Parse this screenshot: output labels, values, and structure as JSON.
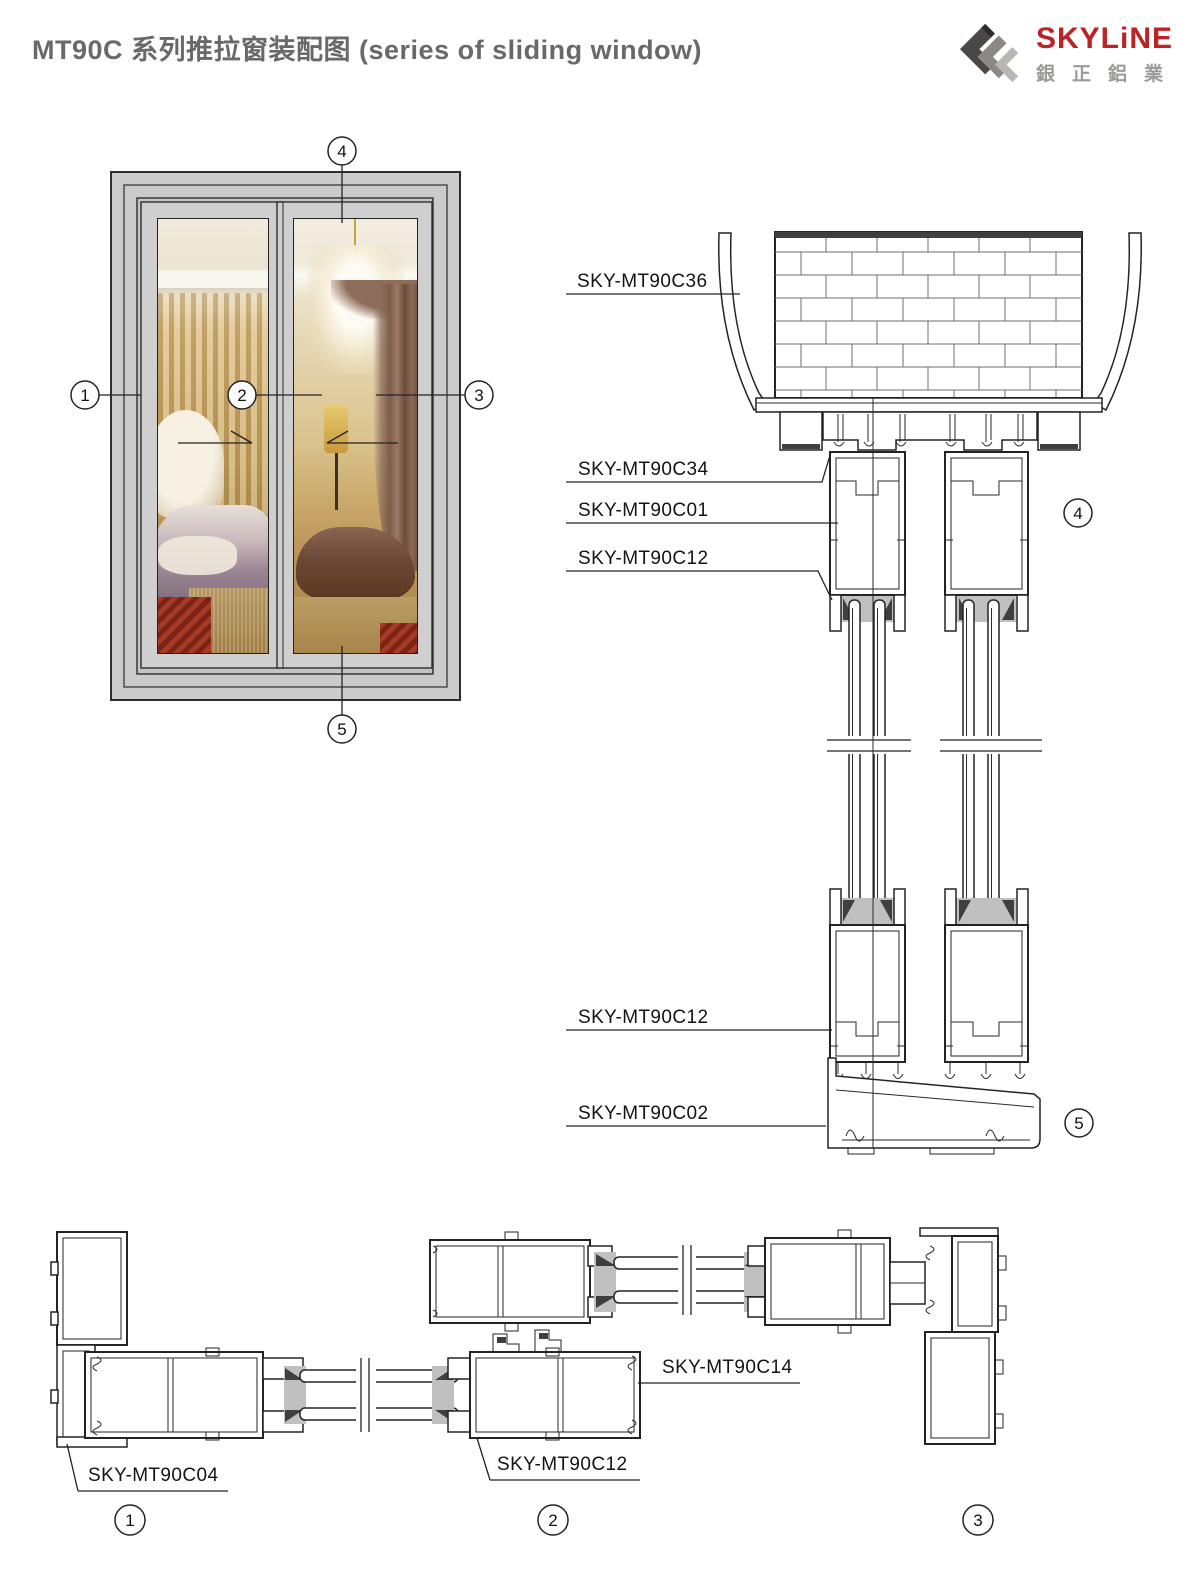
{
  "header": {
    "title": "MT90C 系列推拉窗装配图 (series of  sliding  window)"
  },
  "logo": {
    "brand": "SKYLiNE",
    "chinese": "銀正鋁業"
  },
  "elevation": {
    "callouts": {
      "left": "1",
      "center": "2",
      "right": "3",
      "top": "4",
      "bottom": "5"
    }
  },
  "vertical_section": {
    "labels": [
      {
        "text": "SKY-MT90C36"
      },
      {
        "text": "SKY-MT90C34"
      },
      {
        "text": "SKY-MT90C01"
      },
      {
        "text": "SKY-MT90C12"
      },
      {
        "text": "SKY-MT90C12"
      },
      {
        "text": "SKY-MT90C02"
      }
    ],
    "callouts": [
      {
        "n": "4"
      },
      {
        "n": "5"
      }
    ]
  },
  "horizontal_section": {
    "labels": [
      {
        "text": "SKY-MT90C04"
      },
      {
        "text": "SKY-MT90C14"
      },
      {
        "text": "SKY-MT90C12"
      }
    ],
    "callouts": [
      {
        "n": "1"
      },
      {
        "n": "2"
      },
      {
        "n": "3"
      }
    ]
  },
  "colors": {
    "line": "#232323",
    "brand_red": "#bb2328",
    "brand_gray": "#9a9a98",
    "title_gray": "#696969",
    "frame_gray": "#cbcbcb"
  }
}
